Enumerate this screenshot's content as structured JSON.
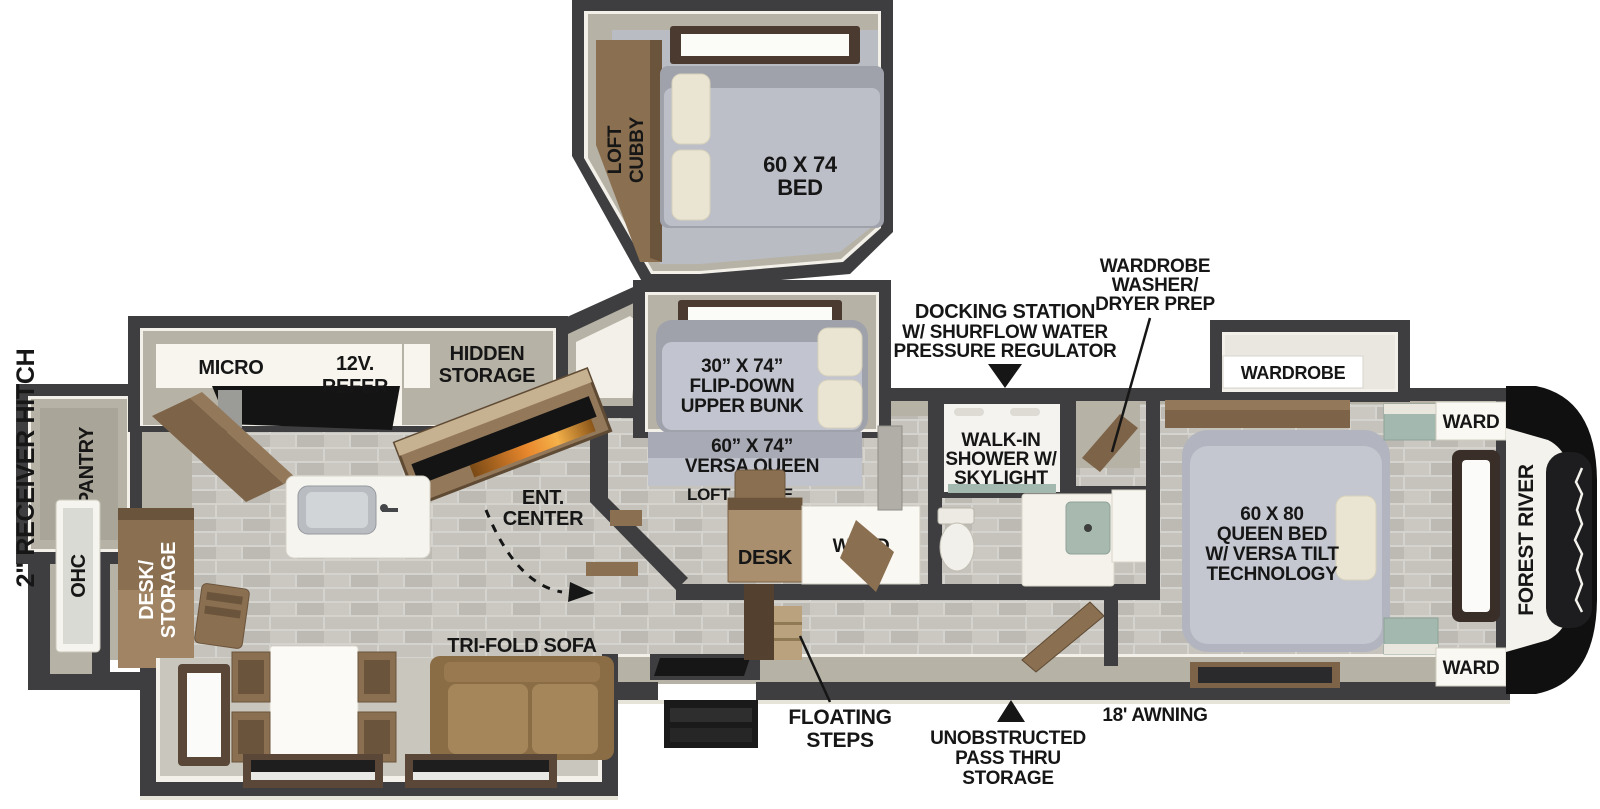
{
  "colors": {
    "wall": "#3e3e40",
    "wall_inner_highlight": "#f2f0e9",
    "beige": "#b6b2a5",
    "beige_light": "#c9c6bd",
    "tile": "#c6c4bd",
    "wood": "#8a6f50",
    "wood_dark": "#54402e",
    "mattress": "#b2b5be",
    "pillow": "#eae5d2",
    "sofa": "#997a50",
    "teal": "#a3b8ae",
    "fire_glow": "#e8872c",
    "label": "#161616"
  },
  "loft": {
    "cubby_line1": "LOFT",
    "cubby_line2": "CUBBY",
    "bed_line1": "60 X 74",
    "bed_line2": "BED"
  },
  "kitchen": {
    "micro": "MICRO",
    "refer_line1": "12V.",
    "refer_line2": "REFER",
    "hidden_line1": "HIDDEN",
    "hidden_line2": "STORAGE",
    "ent_line1": "ENT.",
    "ent_line2": "CENTER"
  },
  "rear": {
    "hitch": "2\" RECEIVER HITCH",
    "pantry": "PANTRY",
    "ohc": "OHC",
    "desk_line1": "DESK/",
    "desk_line2": "STORAGE"
  },
  "living": {
    "sofa": "TRI-FOLD SOFA"
  },
  "bunk_room": {
    "bunk_line1": "30” X 74”",
    "bunk_line2": "FLIP-DOWN",
    "bunk_line3": "UPPER BUNK",
    "queen_line1": "60” X 74”",
    "queen_line2": "VERSA QUEEN",
    "loft_above": "LOFT ABOVE",
    "desk": "DESK",
    "ward": "WARD"
  },
  "bath": {
    "shower_line1": "WALK-IN",
    "shower_line2": "SHOWER W/",
    "shower_line3": "SKYLIGHT"
  },
  "bedroom": {
    "wardrobe": "WARDROBE",
    "ward_top": "WARD",
    "ward_bottom": "WARD",
    "bed_line1": "60 X 80",
    "bed_line2": "QUEEN BED",
    "bed_line3": "W/ VERSA TILT",
    "bed_line4": "TECHNOLOGY"
  },
  "callouts": {
    "dock_line1": "DOCKING STATION",
    "dock_line2": "W/ SHURFLOW WATER",
    "dock_line3": "PRESSURE REGULATOR",
    "wd_line1": "WARDROBE",
    "wd_line2": "WASHER/",
    "wd_line3": "DRYER PREP",
    "steps_line1": "FLOATING",
    "steps_line2": "STEPS",
    "pass_line1": "UNOBSTRUCTED",
    "pass_line2": "PASS THRU",
    "pass_line3": "STORAGE",
    "awning": "18' AWNING"
  },
  "brand": {
    "name": "FOREST RIVER"
  }
}
